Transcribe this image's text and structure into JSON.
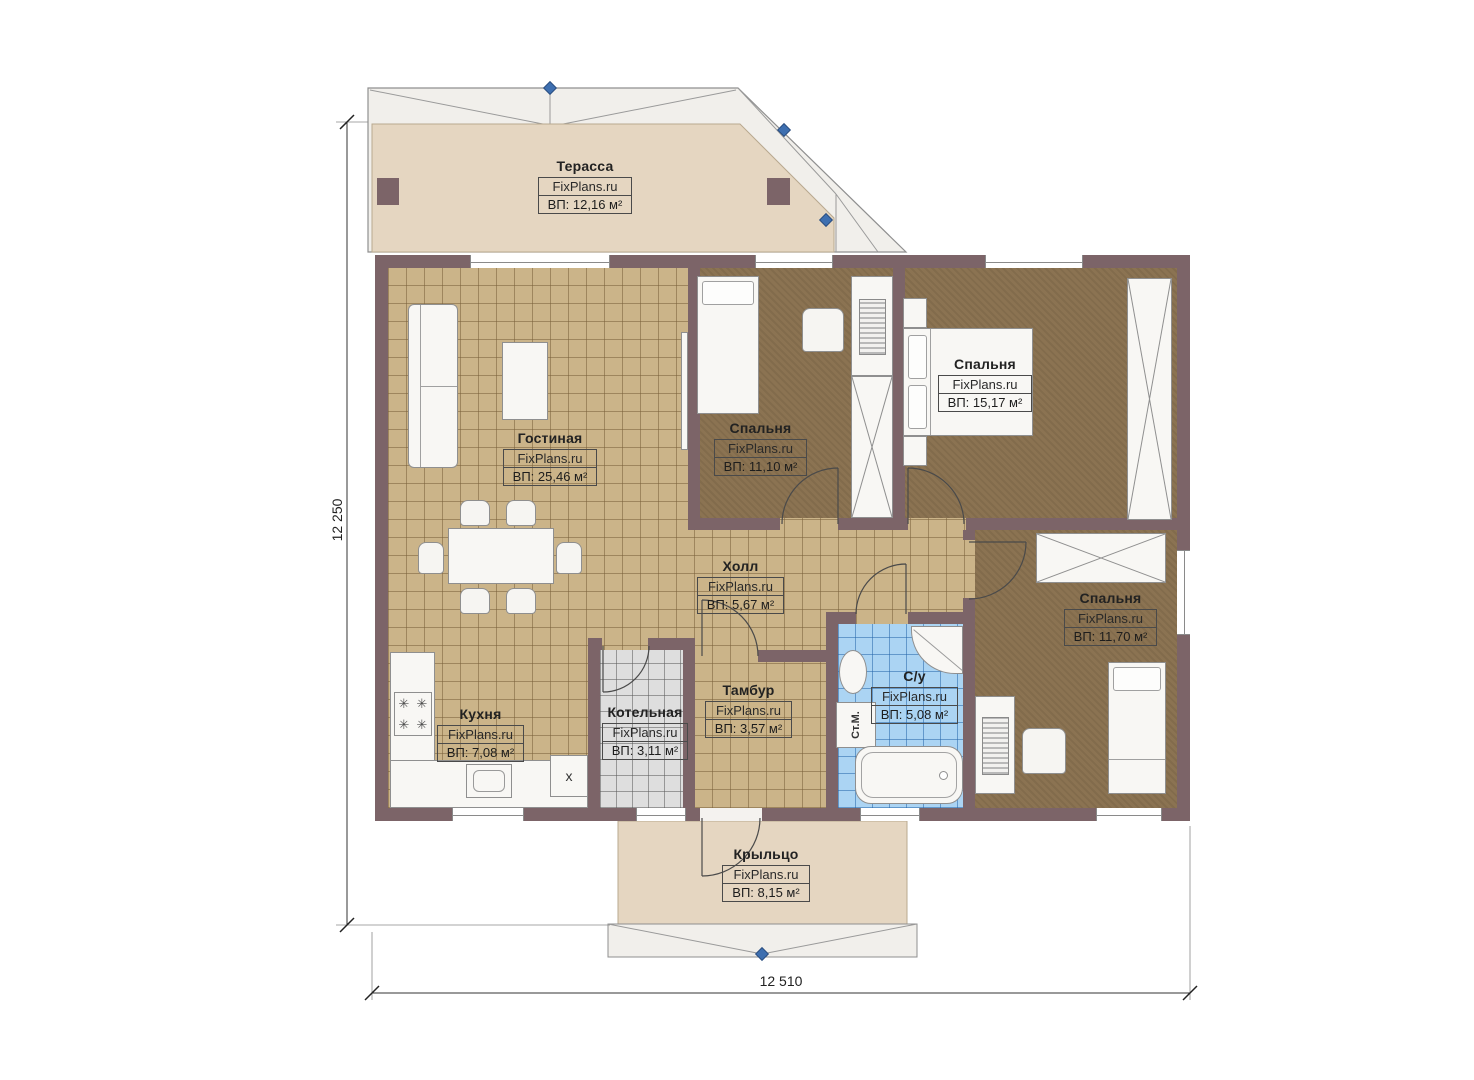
{
  "watermark": "FixPlans.ru",
  "rooms": {
    "terrace": {
      "name": "Терасса",
      "area": "ВП: 12,16 м²"
    },
    "living": {
      "name": "Гостиная",
      "area": "ВП: 25,46 м²"
    },
    "bedroom_center": {
      "name": "Спальня",
      "area": "ВП: 11,10 м²"
    },
    "bedroom_top_right": {
      "name": "Спальня",
      "area": "ВП: 15,17 м²"
    },
    "hall": {
      "name": "Холл",
      "area": "ВП: 5,67 м²"
    },
    "bedroom_right": {
      "name": "Спальня",
      "area": "ВП: 11,70 м²"
    },
    "kitchen": {
      "name": "Кухня",
      "area": "ВП: 7,08 м²"
    },
    "boiler": {
      "name": "Котельная",
      "area": "ВП: 3,11 м²"
    },
    "vestibule": {
      "name": "Тамбур",
      "area": "ВП: 3,57 м²"
    },
    "bathroom": {
      "name": "С/у",
      "area": "ВП: 5,08 м²"
    },
    "porch": {
      "name": "Крыльцо",
      "area": "ВП: 8,15 м²"
    }
  },
  "dimensions": {
    "height_label": "12 250",
    "width_label": "12 510"
  },
  "annotations": {
    "washing_machine": "Ст.М.",
    "fridge_mark": "x"
  },
  "colors": {
    "wall": "#7c6468",
    "tile_beige": "#cbb489",
    "carpet": "#8b7352",
    "tile_blue": "#abd4f3",
    "tile_gray": "#dedede",
    "terrace_floor": "#e5d6c1",
    "roof": "#f1efeb",
    "marker_blue": "#3e6fb0"
  }
}
